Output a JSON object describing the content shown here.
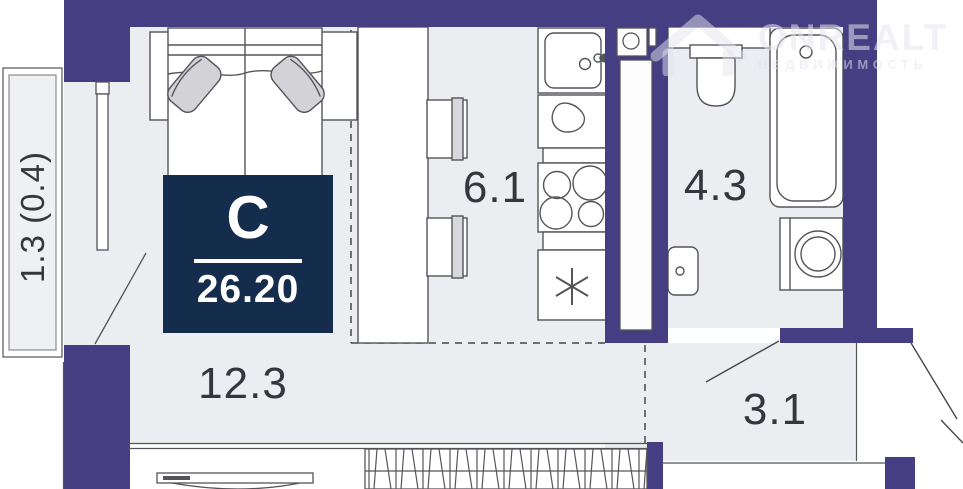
{
  "plan": {
    "unit_type_label": "С",
    "total_area": "26.20",
    "rooms": [
      {
        "id": "balcony",
        "area_label": "1.3 (0.4)"
      },
      {
        "id": "living-room",
        "area_label": "12.3"
      },
      {
        "id": "kitchen",
        "area_label": "6.1"
      },
      {
        "id": "bathroom",
        "area_label": "4.3"
      },
      {
        "id": "hallway",
        "area_label": "3.1"
      }
    ]
  },
  "watermark": {
    "brand": "ONREALT",
    "tagline": "НЕДВИЖИМОСТЬ"
  },
  "colors": {
    "wall": "#463e82",
    "badge": "#152d4c",
    "room_fill": "#ebedf0",
    "outline": "#54545b"
  }
}
